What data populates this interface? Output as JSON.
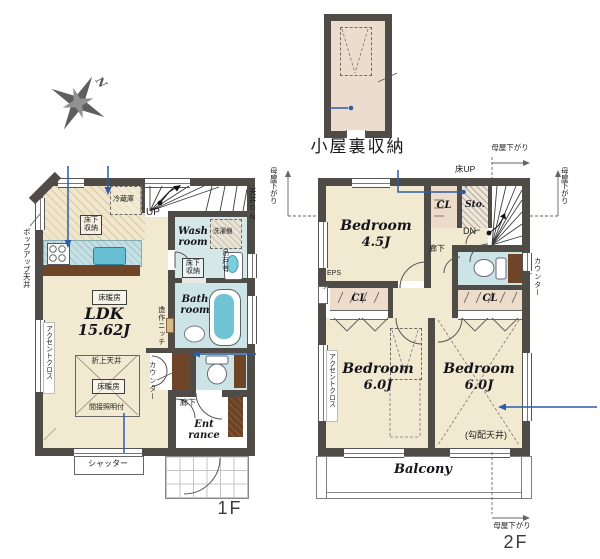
{
  "palette": {
    "wall": "#4f4b46",
    "floor_cream": "#f2e9d1",
    "wet_blue": "#d5e7e6",
    "closet_pink": "#eddcc9",
    "counter_wood": "#6e4526",
    "tub_blue": "#6fc3d4",
    "annotation_blue": "#2d5da9"
  },
  "attic": {
    "label": "小屋裏収納"
  },
  "compass": {
    "north": "N"
  },
  "floor1": {
    "floor_label": "1F",
    "ldk_name": "LDK",
    "ldk_size": "15.62J",
    "wash_room": "Wash\nroom",
    "bath_room": "Bath\nroom",
    "entrance": "Ent\nrance",
    "hallway": "廊下",
    "floor_heating_top": "床暖房",
    "raised_ceiling": "折上天井",
    "floor_heating_center": "床暖房",
    "indirect_lighting": "間接照明付",
    "underfloor_storage_kitchen": "床下収納",
    "underfloor_storage_wash": "床下収納",
    "refrigerator": "冷蔵庫",
    "washing_machine": "洗濯機",
    "up": "UP",
    "ceiling_down": "天井DN",
    "hanging_cupboard": "吊戸有",
    "popup_ceiling": "ポップアップ天井",
    "accent_cloth": "アクセントクロス",
    "built_in_niche": "造作ニッチ",
    "counter": "カウンター",
    "shutter": "シャッター"
  },
  "floor2": {
    "floor_label": "2F",
    "bedroom1_name": "Bedroom",
    "bedroom1_size": "4.5J",
    "bedroom2_name": "Bedroom",
    "bedroom2_size": "6.0J",
    "bedroom3_name": "Bedroom",
    "bedroom3_size": "6.0J",
    "balcony": "Balcony",
    "hallway": "廊下",
    "closet_top": "CL",
    "closet_left": "CL",
    "closet_right": "CL",
    "storage": "Sto.",
    "floor_up": "床UP",
    "down": "DN",
    "eps": "EPS",
    "counter": "カウンター",
    "accent_cloth": "アクセントクロス",
    "sloped_ceiling": "(勾配天井)",
    "moya_top": "母屋下がり",
    "moya_left": "母屋下がり",
    "moya_right": "母屋下がり",
    "moya_bottom": "母屋下がり"
  }
}
